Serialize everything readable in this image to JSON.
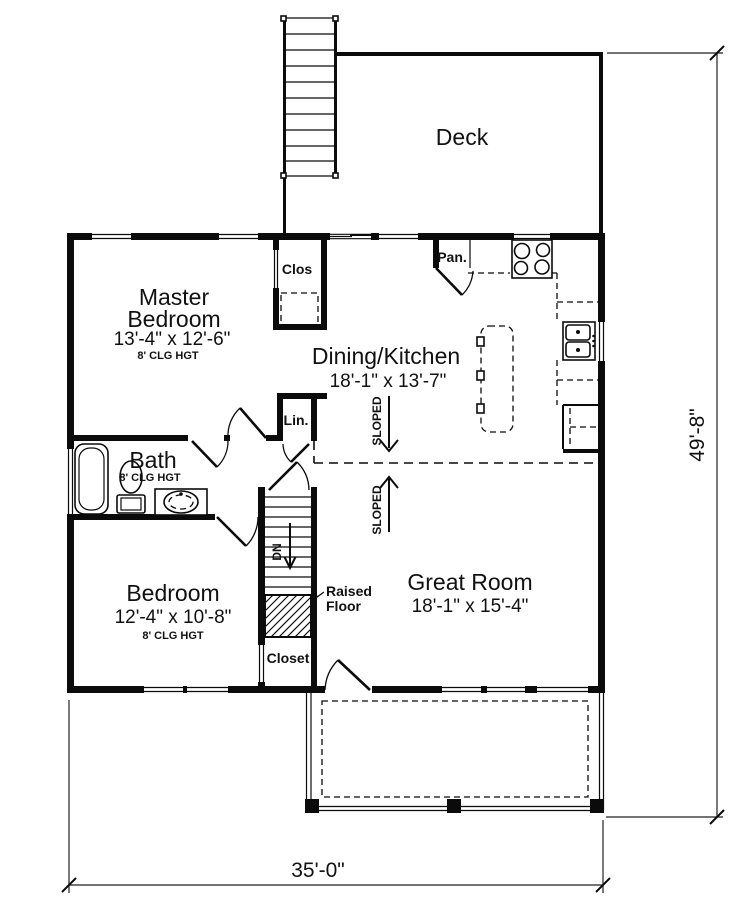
{
  "plan": {
    "rooms": {
      "master": {
        "line1": "Master",
        "line2": "Bedroom",
        "dims": "13'-4\" x 12'-6\"",
        "ceiling": "8' CLG HGT"
      },
      "dining": {
        "name": "Dining/Kitchen",
        "dims": "18'-1\" x 13'-7\""
      },
      "great": {
        "name": "Great Room",
        "dims": "18'-1\" x 15'-4\""
      },
      "bedroom": {
        "name": "Bedroom",
        "dims": "12'-4\" x 10'-8\"",
        "ceiling": "8' CLG HGT"
      },
      "bath": {
        "name": "Bath",
        "ceiling": "8' CLG HGT"
      },
      "deck": {
        "name": "Deck"
      }
    },
    "labels": {
      "closet_upper": "Clos",
      "linen": "Lin.",
      "pantry": "Pan.",
      "closet_lower": "Closet",
      "stairs_down": "DN",
      "raised_floor_line1": "Raised",
      "raised_floor_line2": "Floor",
      "sloped_upper": "SLOPED",
      "sloped_lower": "SLOPED"
    },
    "dimensions": {
      "width": "35'-0\"",
      "depth": "49'-8\""
    },
    "colors": {
      "ink": "#0b0b0b",
      "paper": "#ffffff"
    }
  }
}
